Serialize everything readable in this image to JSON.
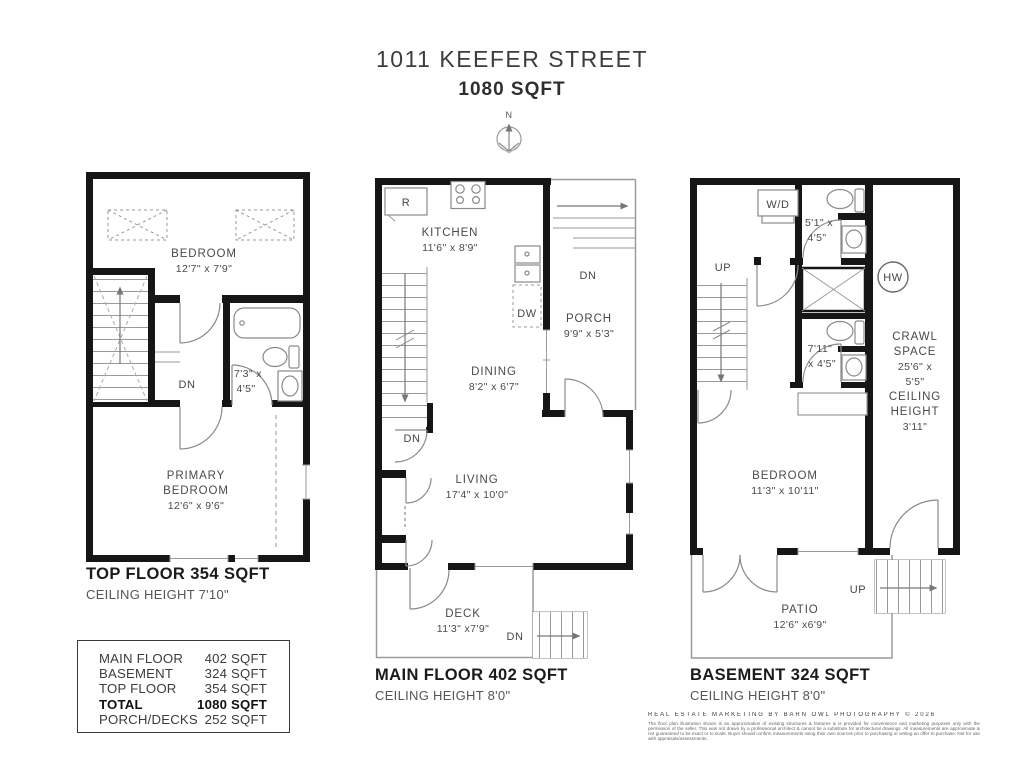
{
  "header": {
    "address": "1011 KEEFER STREET",
    "sqft": "1080 SQFT",
    "compass_n": "N"
  },
  "top_floor": {
    "footer_title": "TOP FLOOR 354 SQFT",
    "footer_sub": "CEILING HEIGHT 7'10\"",
    "bedroom": "BEDROOM",
    "bedroom_dims": "12'7\" x 7'9\"",
    "bath_dims1": "7'3\" x",
    "bath_dims2": "4'5\"",
    "primary1": "PRIMARY",
    "primary2": "BEDROOM",
    "primary_dims": "12'6\" x 9'6\"",
    "dn": "DN"
  },
  "main_floor": {
    "footer_title": "MAIN FLOOR 402 SQFT",
    "footer_sub": "CEILING HEIGHT 8'0\"",
    "fridge": "R",
    "kitchen": "KITCHEN",
    "kitchen_dims": "11'6\" x 8'9\"",
    "dishwasher": "DW",
    "porch_dn": "DN",
    "porch": "PORCH",
    "porch_dims": "9'9\" x 5'3\"",
    "dining": "DINING",
    "dining_dims": "8'2\" x 6'7\"",
    "stairs_dn": "DN",
    "living": "LIVING",
    "living_dims": "17'4\" x 10'0\"",
    "deck": "DECK",
    "deck_dims": "11'3\" x7'9\"",
    "deck_dn": "DN"
  },
  "basement": {
    "footer_title": "BASEMENT 324 SQFT",
    "footer_sub": "CEILING HEIGHT 8'0\"",
    "wd": "W/D",
    "up": "UP",
    "bath1_dims1": "5'1\" x",
    "bath1_dims2": "4'5\"",
    "hw": "HW",
    "bath2_dims1": "7'11\"",
    "bath2_dims2": "x 4'5\"",
    "crawl": [
      "CRAWL",
      "SPACE",
      "25'6\" x",
      "5'5\"",
      "CEILING",
      "HEIGHT",
      "3'11\""
    ],
    "bedroom": "BEDROOM",
    "bedroom_dims": "11'3\" x 10'11\"",
    "patio": "PATIO",
    "patio_dims": "12'6\" x6'9\"",
    "patio_up": "UP"
  },
  "summary": {
    "rows": [
      {
        "label": "MAIN FLOOR",
        "value": "402 SQFT"
      },
      {
        "label": "BASEMENT",
        "value": "324 SQFT"
      },
      {
        "label": "TOP FLOOR",
        "value": "354 SQFT"
      },
      {
        "label": "TOTAL",
        "value": "1080 SQFT"
      },
      {
        "label": "PORCH/DECKS",
        "value": "252 SQFT"
      }
    ]
  },
  "footer": {
    "credit": "REAL ESTATE MARKETING BY BARN OWL PHOTOGRAPHY © 2026",
    "disclaimer": "The floor plan illustration shown is an approximation of existing structures & features & is provided for convenience and marketing purposes only with the permission of the seller. This was not drawn by a professional architect & cannot be a substitute for architectural drawings. All measurements are approximate & not guaranteed to be exact or to scale. Buyer should confirm measurements using their own sources prior to purchasing or writing an offer to purchase. Not for use with appraisals/assessments."
  },
  "colors": {
    "wall": "#161616",
    "fixture": "#8a8a8a",
    "text": "#4a4a4a"
  }
}
